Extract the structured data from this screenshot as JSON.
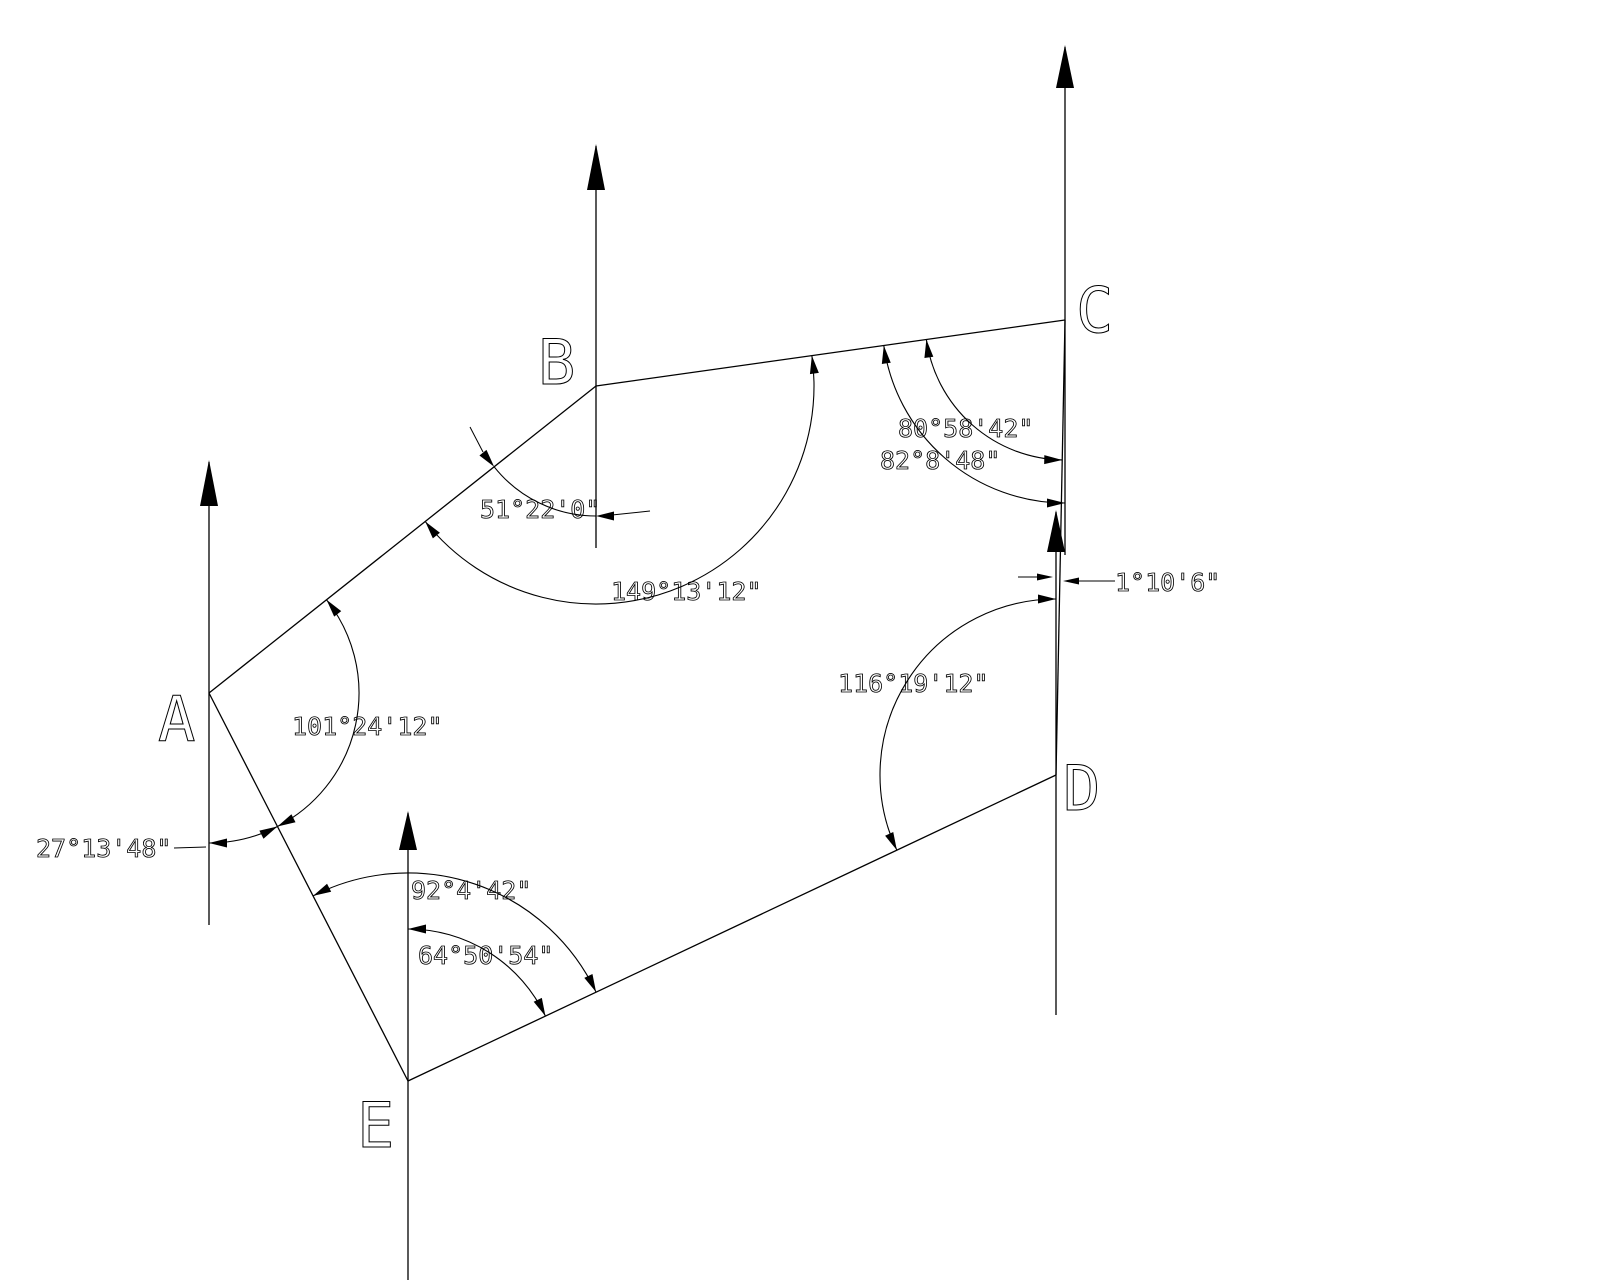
{
  "drawing": {
    "name": "survey-traverse-angle-diagram",
    "width": 1600,
    "height": 1280,
    "background": "#ffffff",
    "line_color": "#000000",
    "vertices": [
      {
        "id": "A",
        "x": 209,
        "y": 693,
        "label": "A",
        "label_x": 158,
        "label_y": 741
      },
      {
        "id": "B",
        "x": 596,
        "y": 386,
        "label": "B",
        "label_x": 538,
        "label_y": 384
      },
      {
        "id": "C",
        "x": 1065,
        "y": 320,
        "label": "C",
        "label_x": 1076,
        "label_y": 332
      },
      {
        "id": "D",
        "x": 1056,
        "y": 775,
        "label": "D",
        "label_x": 1063,
        "label_y": 810
      },
      {
        "id": "E",
        "x": 408,
        "y": 1081,
        "label": "E",
        "label_x": 357,
        "label_y": 1147
      }
    ],
    "edges": [
      [
        "A",
        "B"
      ],
      [
        "B",
        "C"
      ],
      [
        "C",
        "D"
      ],
      [
        "D",
        "E"
      ],
      [
        "E",
        "A"
      ]
    ],
    "meridians": [
      {
        "vertex": "A",
        "x": 209,
        "tip_y": 460,
        "head_base_y": 506,
        "bottom_y": 925
      },
      {
        "vertex": "B",
        "x": 596,
        "tip_y": 144,
        "head_base_y": 190,
        "bottom_y": 548
      },
      {
        "vertex": "C",
        "x": 1065,
        "tip_y": 45,
        "head_base_y": 88,
        "bottom_y": 555
      },
      {
        "vertex": "D",
        "x": 1056,
        "tip_y": 510,
        "head_base_y": 552,
        "bottom_y": 1015
      },
      {
        "vertex": "E",
        "x": 408,
        "tip_y": 811,
        "head_base_y": 850,
        "bottom_y": 1280
      }
    ],
    "meridian_head_half_width": 9,
    "arc_arrow": {
      "length": 18,
      "half_width": 4.5
    },
    "angle_annotations": [
      {
        "name": "angle-B-north-to-BA",
        "label": "51°22'0\"",
        "label_x": 480,
        "label_y": 518,
        "vertex": "B",
        "radius": 130,
        "az_start": 180,
        "az_end": 231.58,
        "arrow_style": "outside"
      },
      {
        "name": "angle-B-BA-to-BC",
        "label": "149°13'12\"",
        "label_x": 611,
        "label_y": 600,
        "vertex": "B",
        "radius": 218,
        "az_start": 81.99,
        "az_end": 231.58,
        "arrow_style": "inside"
      },
      {
        "name": "angle-C-CD-to-CB",
        "label": "80°58'42\"",
        "label_x": 898,
        "label_y": 437,
        "vertex": "C",
        "radius": 140,
        "az_start": 181.13,
        "az_end": 261.99,
        "arrow_style": "inside"
      },
      {
        "name": "angle-C-south-to-CB",
        "label": "82°8'48\"",
        "label_x": 880,
        "label_y": 469,
        "vertex": "C",
        "radius": 183,
        "az_start": 180,
        "az_end": 261.99,
        "arrow_style": "inside"
      },
      {
        "name": "angle-D-DE-to-north",
        "label": "116°19'12\"",
        "label_x": 838,
        "label_y": 692,
        "vertex": "D",
        "radius": 176,
        "az_start": 244.72,
        "az_end": 360,
        "arrow_style": "inside"
      },
      {
        "name": "angle-A-AB-to-AE",
        "label": "101°24'12\"",
        "label_x": 292,
        "label_y": 735,
        "vertex": "A",
        "radius": 150,
        "az_start": 51.58,
        "az_end": 152.85,
        "arrow_style": "inside"
      },
      {
        "name": "angle-A-AE-to-south",
        "label": "27°13'48\"",
        "label_x": 36,
        "label_y": 857,
        "vertex": "A",
        "radius": 150,
        "az_start": 152.85,
        "az_end": 180,
        "arrow_style": "inside"
      },
      {
        "name": "angle-E-EA-to-ED",
        "label": "92°4'42\"",
        "label_x": 411,
        "label_y": 899,
        "vertex": "E",
        "radius": 208,
        "az_start": 332.85,
        "az_end": 424.72,
        "arrow_style": "inside"
      },
      {
        "name": "angle-E-north-to-ED",
        "label": "64°50'54\"",
        "label_x": 418,
        "label_y": 964,
        "vertex": "E",
        "radius": 152,
        "az_start": 0,
        "az_end": 64.72,
        "arrow_style": "inside"
      },
      {
        "name": "angle-D-north-to-DC",
        "label": "1°10'6\"",
        "label_x": 1115,
        "label_y": 591,
        "vertex": "D",
        "radius": null,
        "az_start": null,
        "az_end": null,
        "arrow_style": "opposed"
      }
    ],
    "free_arrows": [
      {
        "name": "tiny-angle-left-arrow",
        "tip_x": 1053,
        "tip_y": 577,
        "dir_deg": 0
      },
      {
        "name": "tiny-angle-right-arrow",
        "tip_x": 1063,
        "tip_y": 581,
        "dir_deg": 180
      }
    ],
    "leader_lines": [
      {
        "name": "tiny-angle-left-tail",
        "x1": 1018,
        "y1": 577,
        "x2": 1037,
        "y2": 577
      },
      {
        "name": "tiny-angle-text-leader",
        "x1": 1079,
        "y1": 581,
        "x2": 1115,
        "y2": 581
      },
      {
        "name": "label-27-leader",
        "x1": 174,
        "y1": 848,
        "x2": 206,
        "y2": 847
      },
      {
        "name": "label-51-leader",
        "x1": 612,
        "y1": 515,
        "x2": 650,
        "y2": 511
      },
      {
        "name": "arc-51-outer-tail",
        "x1": 483,
        "y1": 452,
        "x2": 470,
        "y2": 427
      }
    ]
  }
}
